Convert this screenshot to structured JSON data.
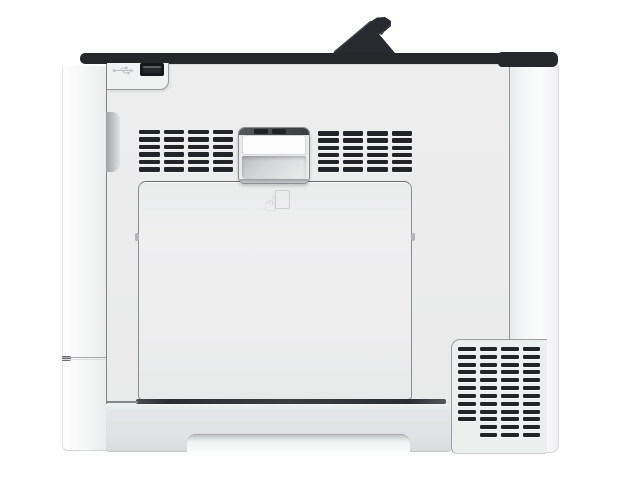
{
  "scene": {
    "description": "Front-view product photo of a white laser printer: dark top edge with raised paper stopper, USB port at top left, two top ventilation grilles, recessed pull handle, large front access door with faint push-to-open hand icon, bottom-right ventilation grille, and a paper drawer with grip recess at the bottom.",
    "background_color": "#ffffff"
  },
  "printer": {
    "colors": {
      "top_bar": "#25272b",
      "paper_stopper": "#282a2f",
      "front_face": "#ebeceb",
      "side_panel": "#f6f7f7",
      "door": "#ededee",
      "tray": "#e2e3e4",
      "vent_slot": "#222427",
      "seam": "#97999b",
      "usb_port": "#17181b"
    },
    "icons": [
      {
        "name": "usb-icon",
        "meaning": "USB port marking"
      },
      {
        "name": "push-open-hand-icon",
        "meaning": "press here to open front cover"
      }
    ],
    "vents": {
      "top_left": {
        "rows": 6,
        "cols": 4,
        "slot_height": 4.5,
        "col_gap": 4
      },
      "top_right": {
        "rows": 6,
        "cols": 4,
        "slot_height": 4.5,
        "col_gap": 4
      },
      "bottom_right": {
        "rows": 12,
        "cols": 4,
        "slot_height": 4,
        "col_gap": 4,
        "indent_last_rows": 2
      }
    }
  }
}
